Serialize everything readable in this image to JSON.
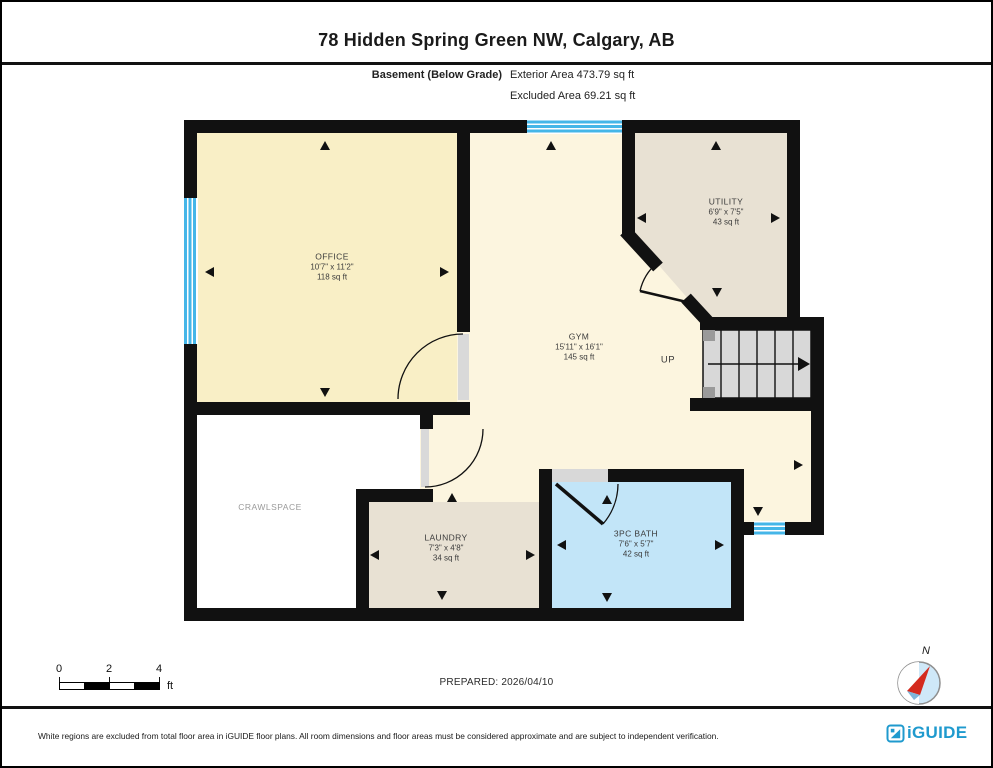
{
  "title": "78 Hidden Spring Green NW, Calgary, AB",
  "header": {
    "floor_label": "Basement (Below Grade)",
    "exterior_area": "Exterior Area 473.79 sq ft",
    "excluded_area": "Excluded Area 69.21 sq ft"
  },
  "rooms": [
    {
      "id": "office",
      "name": "OFFICE",
      "dimensions": "10'7\" x 11'2\"",
      "area": "118 sq ft"
    },
    {
      "id": "gym",
      "name": "GYM",
      "dimensions": "15'11\" x 16'1\"",
      "area": "145 sq ft"
    },
    {
      "id": "utility",
      "name": "UTILITY",
      "dimensions": "6'9\" x 7'5\"",
      "area": "43 sq ft"
    },
    {
      "id": "crawlspace",
      "name": "CRAWLSPACE",
      "dimensions": "",
      "area": ""
    },
    {
      "id": "laundry",
      "name": "LAUNDRY",
      "dimensions": "7'3\" x 4'8\"",
      "area": "34 sq ft"
    },
    {
      "id": "bath",
      "name": "3PC BATH",
      "dimensions": "7'6\" x 5'7\"",
      "area": "42 sq ft"
    }
  ],
  "stairs_label": "UP",
  "scale_bar": {
    "tick0": "0",
    "tick2": "2",
    "tick4": "4",
    "unit": "ft"
  },
  "prepared": "PREPARED: 2026/04/10",
  "compass_label": "N",
  "footer": {
    "disclaimer": "White regions are excluded from total floor area in iGUIDE floor plans. All room dimensions and floor areas must be considered approximate and are subject to independent verification.",
    "brand": "iGUIDE"
  },
  "colors": {
    "wall": "#111111",
    "window_blue": "#45b6e8",
    "office_fill": "#f9efc6",
    "gym_fill": "#fcf5df",
    "utility_fill": "#e8e1d3",
    "laundry_fill": "#e8e1d3",
    "bath_fill": "#c2e5f8",
    "crawlspace_fill": "#ffffff",
    "stairs_fill": "#d8d8d8",
    "brand_teal": "#1f9ace"
  }
}
